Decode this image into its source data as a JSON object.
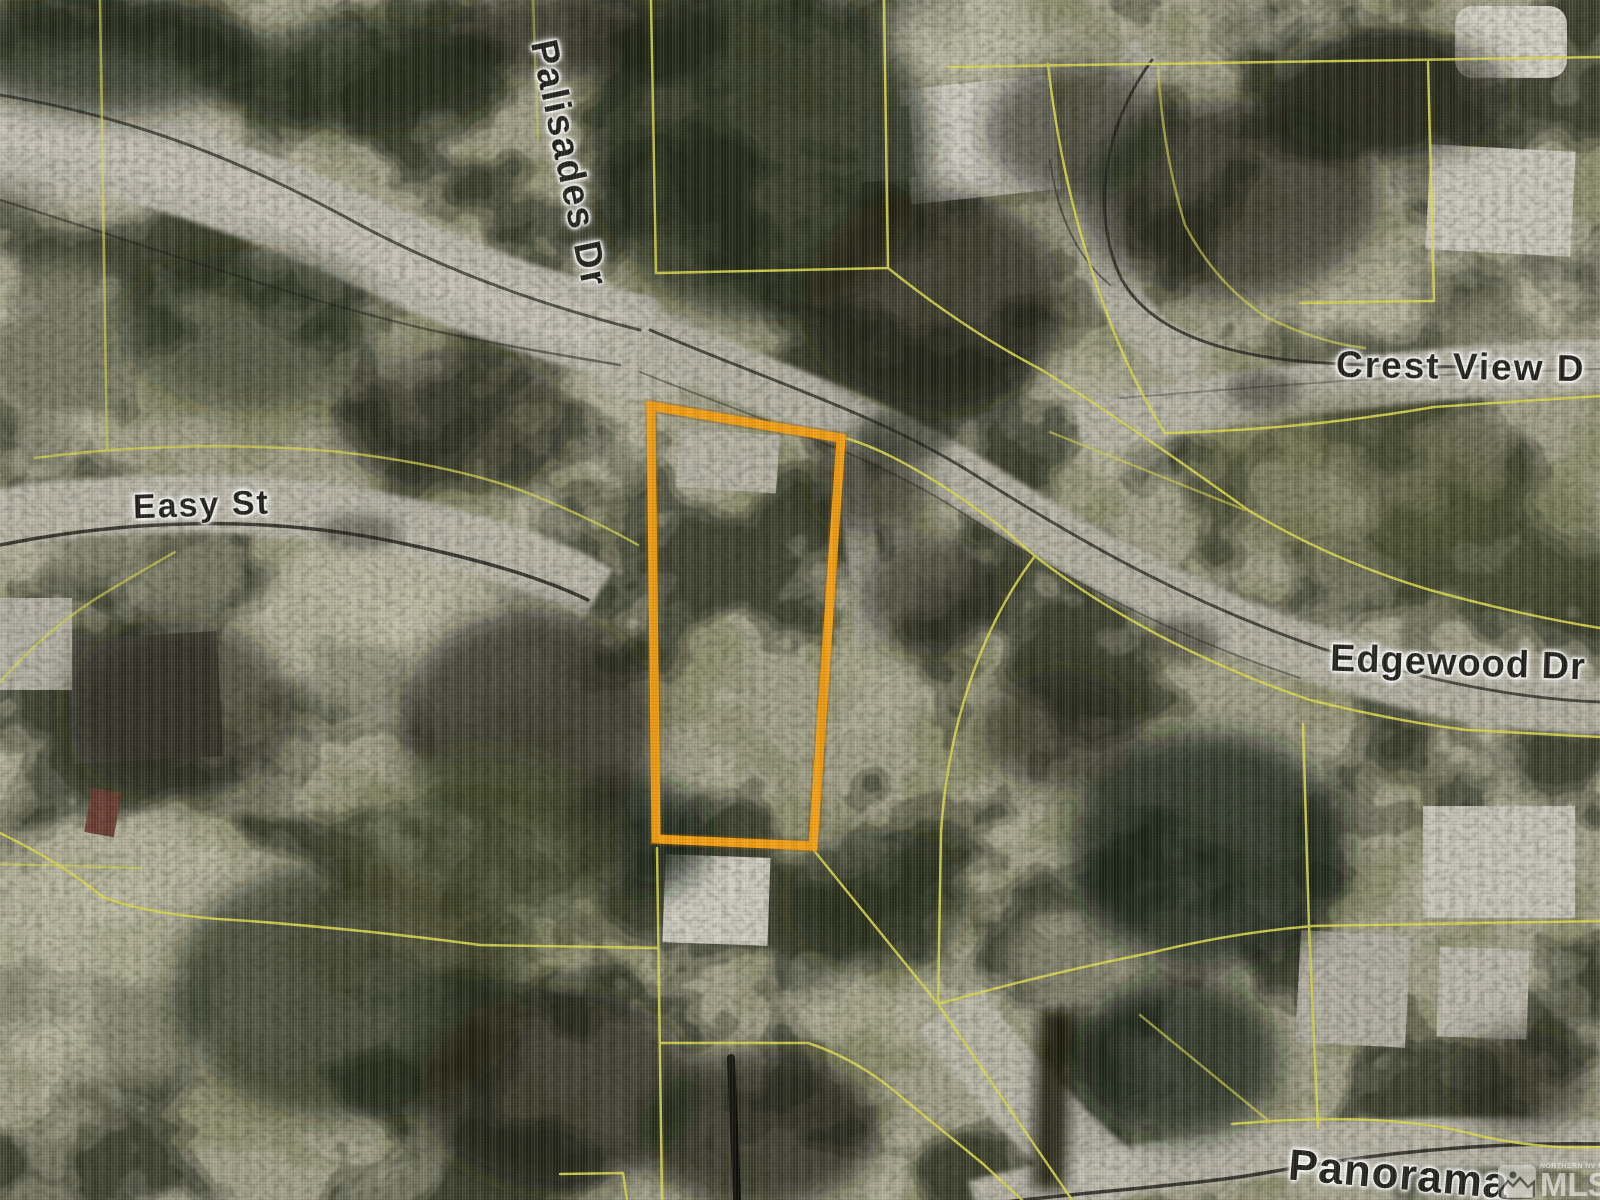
{
  "map": {
    "kind": "aerial parcel map screenshot with lot lines and highlighted subject lot",
    "streets": [
      {
        "id": "palisades",
        "name": "Palisades Dr"
      },
      {
        "id": "easy",
        "name": "Easy St"
      },
      {
        "id": "crest",
        "name": "Crest View D"
      },
      {
        "id": "edgewood",
        "name": "Edgewood Dr"
      },
      {
        "id": "panorama",
        "name": "Panorama"
      }
    ],
    "subject_parcel": {
      "description": "tall quadrilateral lot outlined in orange",
      "outline_color": "#F09D12"
    },
    "parcel_line_color": "#D8D64C",
    "watermark": {
      "brand": "MLS",
      "region_text": "NORTHERN NV REGIONAL",
      "icon": "mountain-sun-logo"
    }
  }
}
